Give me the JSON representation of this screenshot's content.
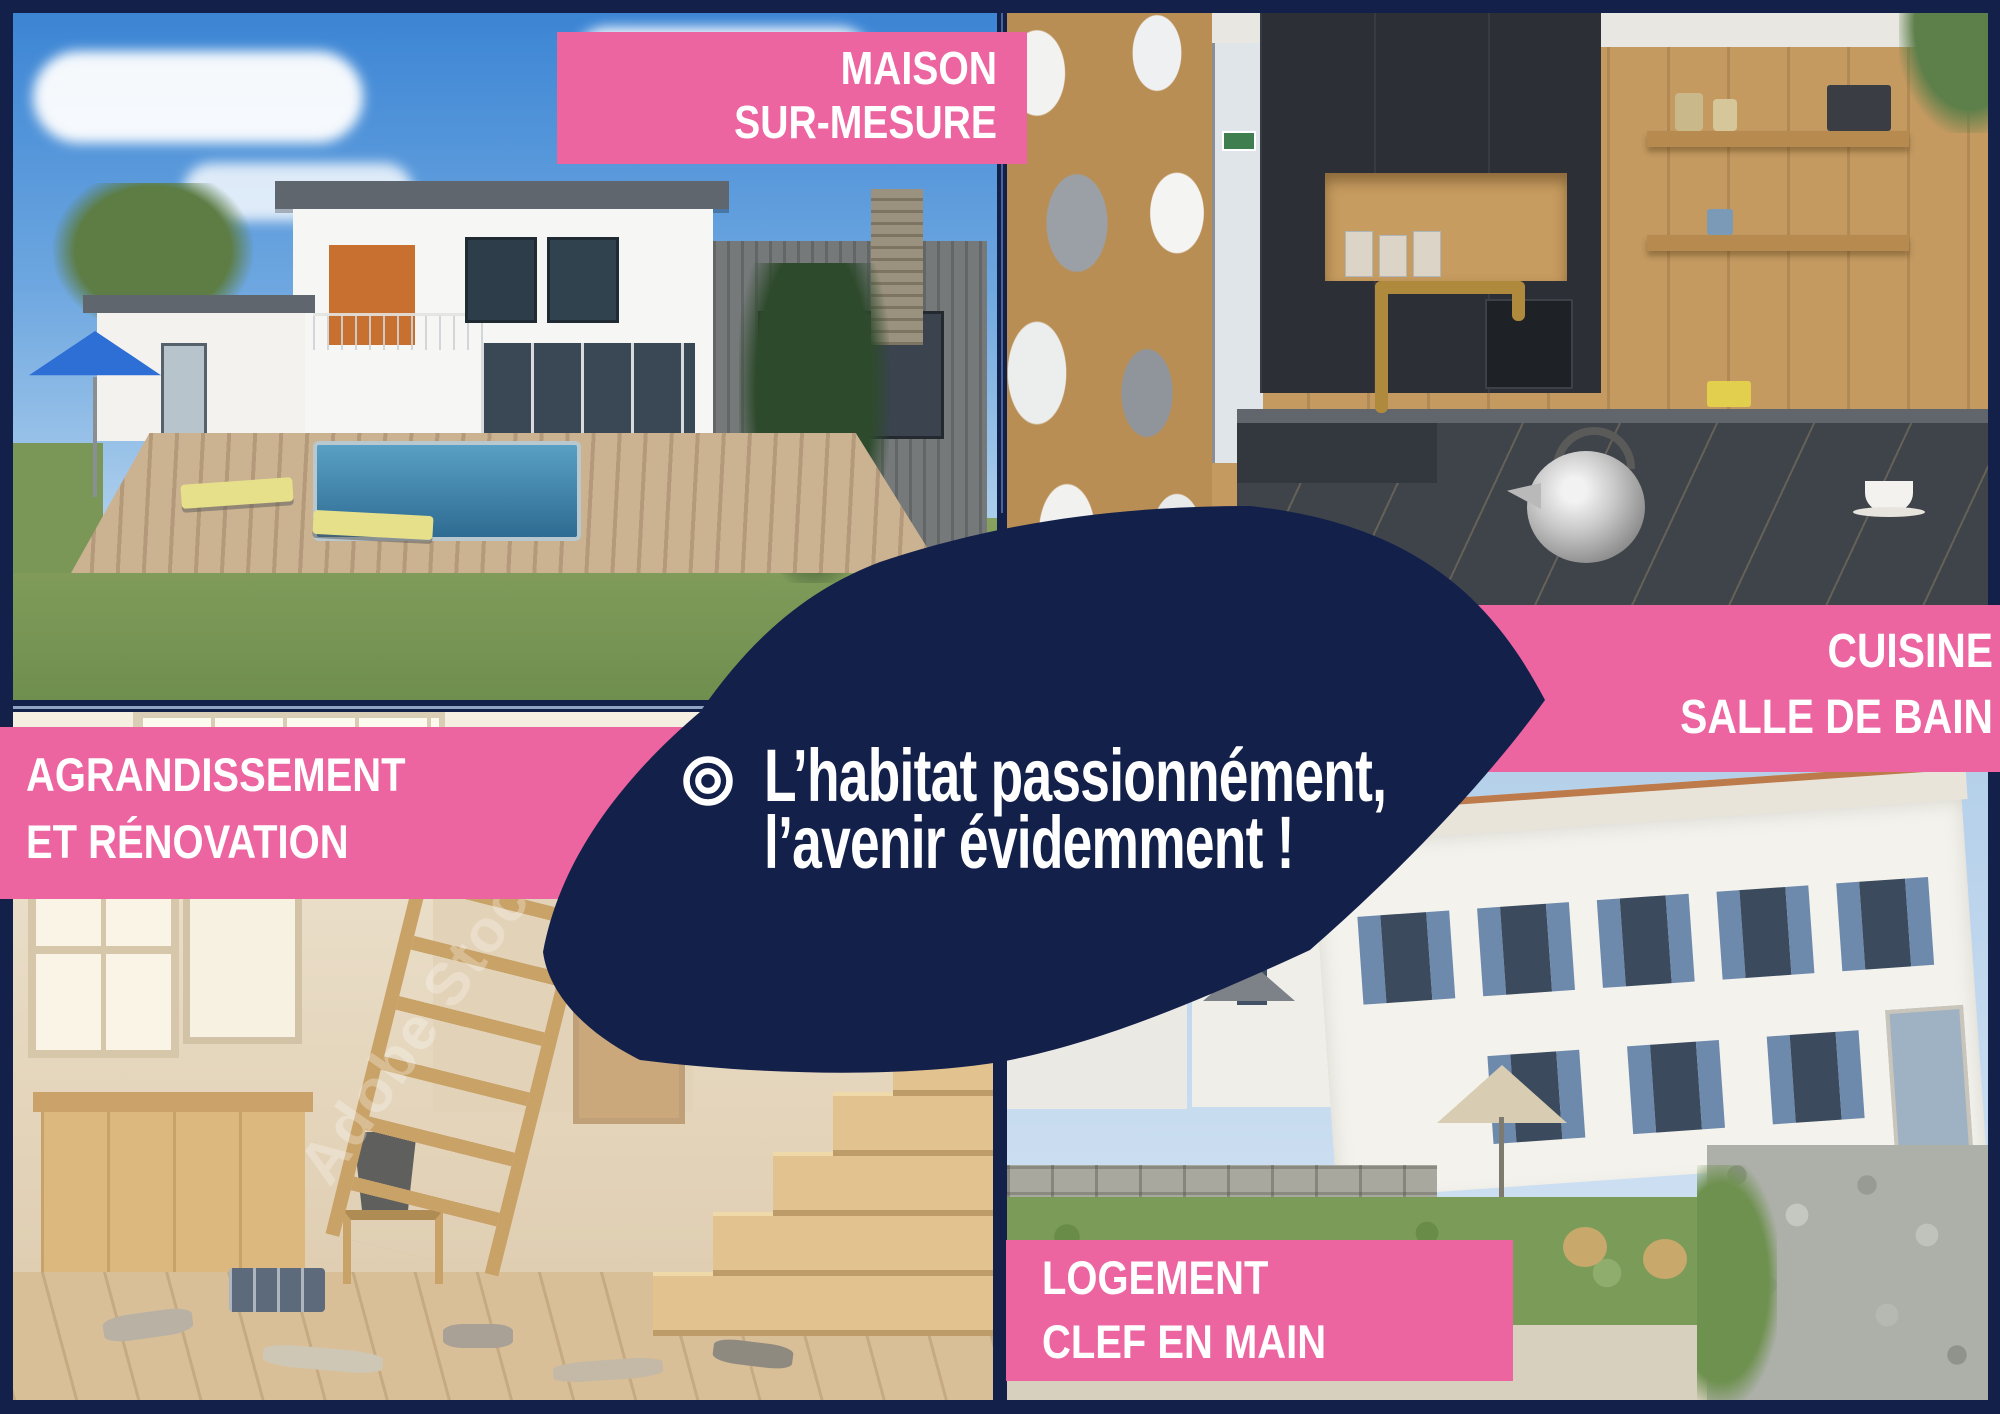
{
  "colors": {
    "navy": "#13204A",
    "pink": "#EC64A0",
    "text": "#FFFFFF"
  },
  "banners": {
    "maison": {
      "line1": "MAISON",
      "line2": "SUR-MESURE"
    },
    "cuisine": {
      "line1": "CUISINE",
      "line2": "SALLE DE BAIN"
    },
    "agrandissement": {
      "line1": "AGRANDISSEMENT",
      "line2": "ET RÉNOVATION"
    },
    "logement": {
      "line1": "LOGEMENT",
      "line2": "CLEF EN MAIN"
    }
  },
  "slogan": {
    "line1": "L’habitat passionnément,",
    "line2": "l’avenir évidemment !"
  },
  "watermark": "Adobe Stock"
}
